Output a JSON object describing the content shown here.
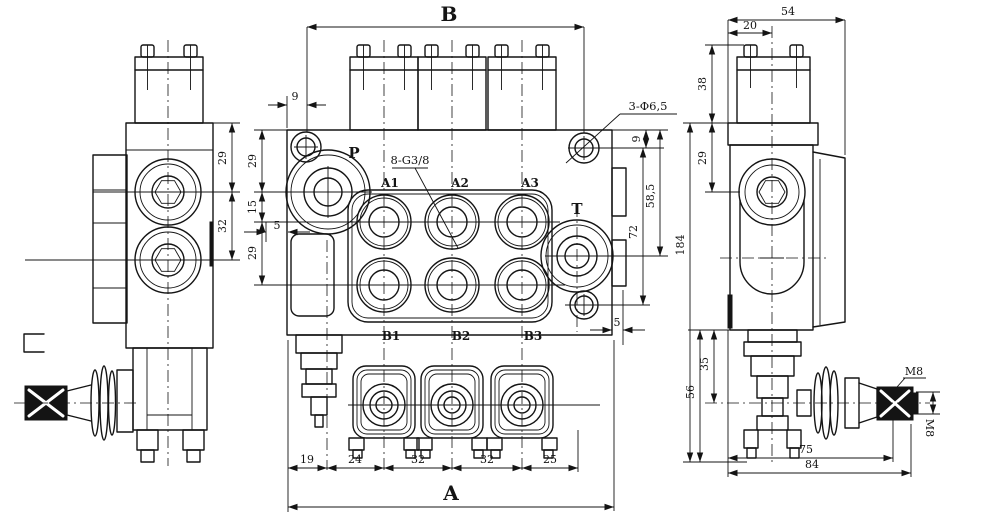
{
  "drawing": {
    "left_view": {
      "dim_29": "29",
      "dim_32": "32"
    },
    "front_view": {
      "dim_B": "B",
      "dim_A": "A",
      "dim_9_top": "9",
      "dim_29_upper": "29",
      "dim_15": "15",
      "dim_29_lower": "29",
      "dim_5_left": "5",
      "port_P": "P",
      "port_T": "T",
      "port_A1": "A1",
      "port_A2": "A2",
      "port_A3": "A3",
      "port_B1": "B1",
      "port_B2": "B2",
      "port_B3": "B3",
      "note_ports": "8-G3/8",
      "note_holes": "3-Φ6,5",
      "dim_9_right": "9",
      "dim_58_5": "58,5",
      "dim_72": "72",
      "dim_5_right": "5",
      "dim_19": "19",
      "dim_24": "24",
      "dim_32_a": "32",
      "dim_32_b": "32",
      "dim_25": "25"
    },
    "right_view": {
      "dim_54": "54",
      "dim_20": "20",
      "dim_38": "38",
      "dim_29": "29",
      "dim_184": "184",
      "dim_56": "56",
      "dim_35": "35",
      "dim_75": "75",
      "dim_84": "84",
      "thread_top": "M8",
      "thread_side": "M8"
    }
  }
}
